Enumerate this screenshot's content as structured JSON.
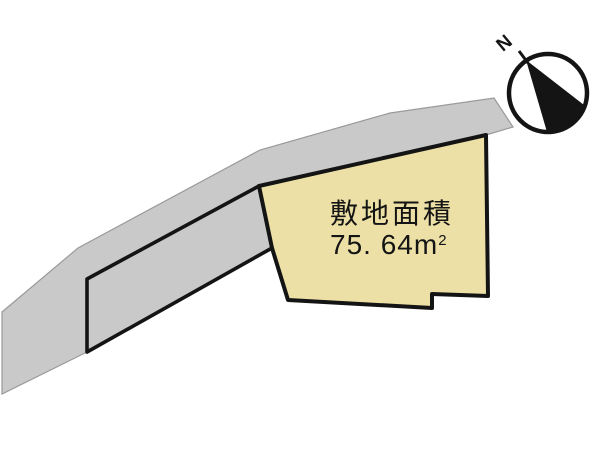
{
  "diagram": {
    "type": "real-estate site plan",
    "plot": {
      "area_label": "敷地面積",
      "area_value": "75. 64",
      "area_unit_base": "m",
      "area_unit_exponent": "2"
    },
    "compass": {
      "north_label": "N"
    },
    "colors": {
      "background": "#ffffff",
      "road_fill": "#c9c9c9",
      "road_edge": "#9a9a9a",
      "frontage_stroke": "#141414",
      "plot_fill": "#ede0a6",
      "plot_stroke": "#141414",
      "compass_ring": "#141414",
      "compass_needle": "#141414"
    }
  }
}
